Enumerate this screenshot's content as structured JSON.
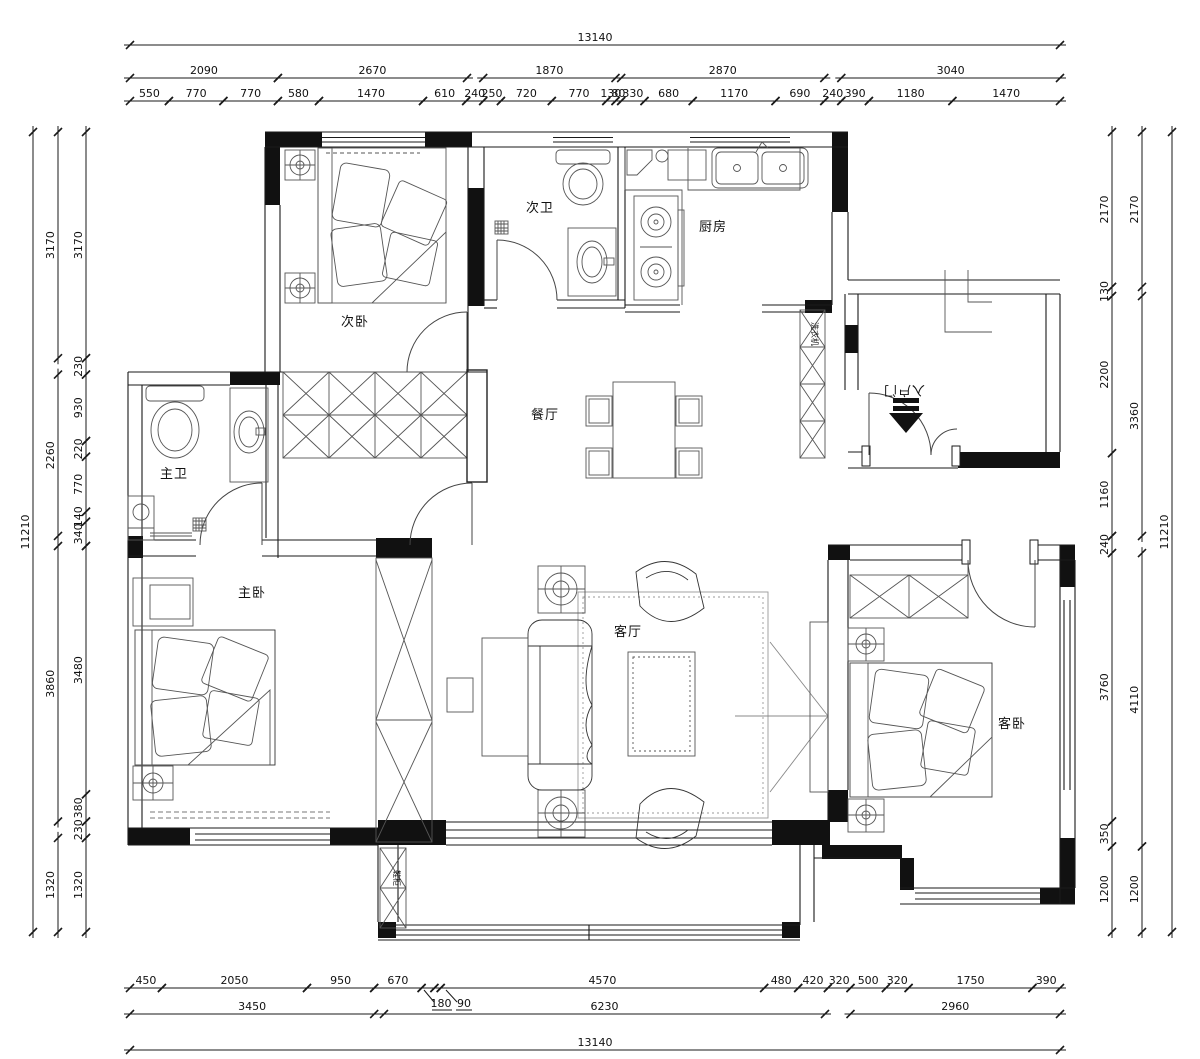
{
  "drawing": {
    "type": "apartment-floor-plan",
    "units": "mm",
    "line_color": "#1a1a1a",
    "furniture_color": "#555555"
  },
  "rooms": [
    {
      "id": "bedroom2",
      "label": "次卧",
      "x": 355,
      "y": 326
    },
    {
      "id": "bath2",
      "label": "次卫",
      "x": 540,
      "y": 212
    },
    {
      "id": "kitchen",
      "label": "厨房",
      "x": 713,
      "y": 231
    },
    {
      "id": "dining",
      "label": "餐厅",
      "x": 545,
      "y": 419
    },
    {
      "id": "bath1",
      "label": "主卫",
      "x": 174,
      "y": 478
    },
    {
      "id": "bedroom1",
      "label": "主卧",
      "x": 252,
      "y": 597
    },
    {
      "id": "living",
      "label": "客厅",
      "x": 628,
      "y": 636
    },
    {
      "id": "bedroom3",
      "label": "客卧",
      "x": 1012,
      "y": 728
    }
  ],
  "annotations": [
    {
      "id": "entry-door",
      "label": "入户门",
      "x": 904,
      "y": 386,
      "rotate": 180,
      "size": 12
    },
    {
      "id": "washing-machine",
      "label": "洗衣机",
      "x": 812,
      "y": 334,
      "rotate": 90,
      "size": 8
    },
    {
      "id": "shoe-cabinet",
      "label": "鞋柜",
      "x": 394,
      "y": 878,
      "rotate": 90,
      "size": 8
    }
  ],
  "leader_labels": [
    {
      "label": "180",
      "x": 441,
      "y": 1007
    },
    {
      "label": "90",
      "x": 464,
      "y": 1007
    }
  ],
  "dim_chains": [
    {
      "id": "top-overall",
      "orient": "h",
      "pos": 45,
      "segments": [
        [
          130,
          1060,
          "13140"
        ]
      ]
    },
    {
      "id": "top-groups",
      "orient": "h",
      "pos": 78,
      "segments": [
        [
          130,
          277.9,
          "2090"
        ],
        [
          277.9,
          467,
          "2670"
        ],
        [
          483.2,
          615.5,
          "1870"
        ],
        [
          621.2,
          824.3,
          "2870"
        ],
        [
          841.3,
          1060,
          "3040"
        ]
      ]
    },
    {
      "id": "top-detail",
      "orient": "h",
      "pos": 101,
      "segments": [
        [
          130,
          168.9,
          "550"
        ],
        [
          168.9,
          223.4,
          "770"
        ],
        [
          223.4,
          277.9,
          "770"
        ],
        [
          277.9,
          319,
          "580"
        ],
        [
          319,
          423,
          "1470"
        ],
        [
          423,
          466.2,
          "610"
        ],
        [
          466.2,
          483.2,
          "240"
        ],
        [
          483.2,
          500.9,
          "250"
        ],
        [
          500.9,
          551.8,
          "720"
        ],
        [
          551.8,
          606.3,
          "770"
        ],
        [
          606.3,
          615.5,
          "130"
        ],
        [
          615.5,
          621.2,
          "80"
        ],
        [
          621.2,
          644.5,
          "330"
        ],
        [
          644.5,
          692.7,
          "680"
        ],
        [
          692.7,
          775.5,
          "1170"
        ],
        [
          775.5,
          824.3,
          "690"
        ],
        [
          824.3,
          841.3,
          "240"
        ],
        [
          841.3,
          868.9,
          "390"
        ],
        [
          868.9,
          952.4,
          "1180"
        ],
        [
          952.4,
          1060,
          "1470"
        ]
      ]
    },
    {
      "id": "left-outer",
      "orient": "v",
      "pos": 33,
      "segments": [
        [
          132,
          932,
          "11210"
        ]
      ]
    },
    {
      "id": "left-mid",
      "orient": "v",
      "pos": 58,
      "segments": [
        [
          132,
          358.2,
          "3170"
        ],
        [
          374.6,
          535.9,
          "2260"
        ],
        [
          546,
          821.5,
          "3860"
        ],
        [
          837.9,
          932,
          "1320"
        ]
      ]
    },
    {
      "id": "left-inner",
      "orient": "v",
      "pos": 86,
      "segments": [
        [
          132,
          358.2,
          "3170"
        ],
        [
          358.2,
          374.6,
          "230"
        ],
        [
          374.6,
          441,
          "930"
        ],
        [
          441,
          456.7,
          "220"
        ],
        [
          456.7,
          511.7,
          "770"
        ],
        [
          511.7,
          521.7,
          "140"
        ],
        [
          521.7,
          546,
          "340"
        ],
        [
          546,
          794.3,
          "3480"
        ],
        [
          794.3,
          821.5,
          "380"
        ],
        [
          821.5,
          837.9,
          "230"
        ],
        [
          837.9,
          932,
          "1320"
        ]
      ]
    },
    {
      "id": "right-inner",
      "orient": "v",
      "pos": 1112,
      "segments": [
        [
          132,
          286.9,
          "2170"
        ],
        [
          286.9,
          296.1,
          "130"
        ],
        [
          296.1,
          453.2,
          "2200"
        ],
        [
          453.2,
          536,
          "1160"
        ],
        [
          536,
          553.1,
          "240"
        ],
        [
          553.1,
          821.4,
          "3760"
        ],
        [
          821.4,
          846.4,
          "350"
        ],
        [
          846.4,
          932,
          "1200"
        ]
      ]
    },
    {
      "id": "right-mid",
      "orient": "v",
      "pos": 1142,
      "segments": [
        [
          132,
          286.9,
          "2170"
        ],
        [
          296.1,
          536,
          "3360"
        ],
        [
          553.1,
          846.4,
          "4110"
        ],
        [
          846.4,
          932,
          "1200"
        ]
      ]
    },
    {
      "id": "right-outer",
      "orient": "v",
      "pos": 1172,
      "segments": [
        [
          132,
          932,
          "11210"
        ]
      ]
    },
    {
      "id": "bottom-detail",
      "orient": "h",
      "pos": 988,
      "segments": [
        [
          130,
          161.9,
          "450"
        ],
        [
          161.9,
          307,
          "2050"
        ],
        [
          307,
          374.2,
          "950"
        ],
        [
          374.2,
          421.6,
          "670"
        ],
        [
          421.6,
          434.4,
          ""
        ],
        [
          434.4,
          440.7,
          ""
        ],
        [
          440.7,
          764.2,
          "4570"
        ],
        [
          764.2,
          798.2,
          "480"
        ],
        [
          798.2,
          827.9,
          "420"
        ],
        [
          827.9,
          850.5,
          "320"
        ],
        [
          850.5,
          885.9,
          "500"
        ],
        [
          885.9,
          908.6,
          "320"
        ],
        [
          908.6,
          1032.4,
          "1750"
        ],
        [
          1032.4,
          1060,
          "390"
        ]
      ]
    },
    {
      "id": "bottom-groups",
      "orient": "h",
      "pos": 1014,
      "segments": [
        [
          130,
          374.2,
          "3450"
        ],
        [
          384,
          825,
          "6230"
        ],
        [
          850.5,
          1060,
          "2960"
        ]
      ]
    },
    {
      "id": "bottom-overall",
      "orient": "h",
      "pos": 1050,
      "segments": [
        [
          130,
          1060,
          "13140"
        ]
      ]
    }
  ]
}
